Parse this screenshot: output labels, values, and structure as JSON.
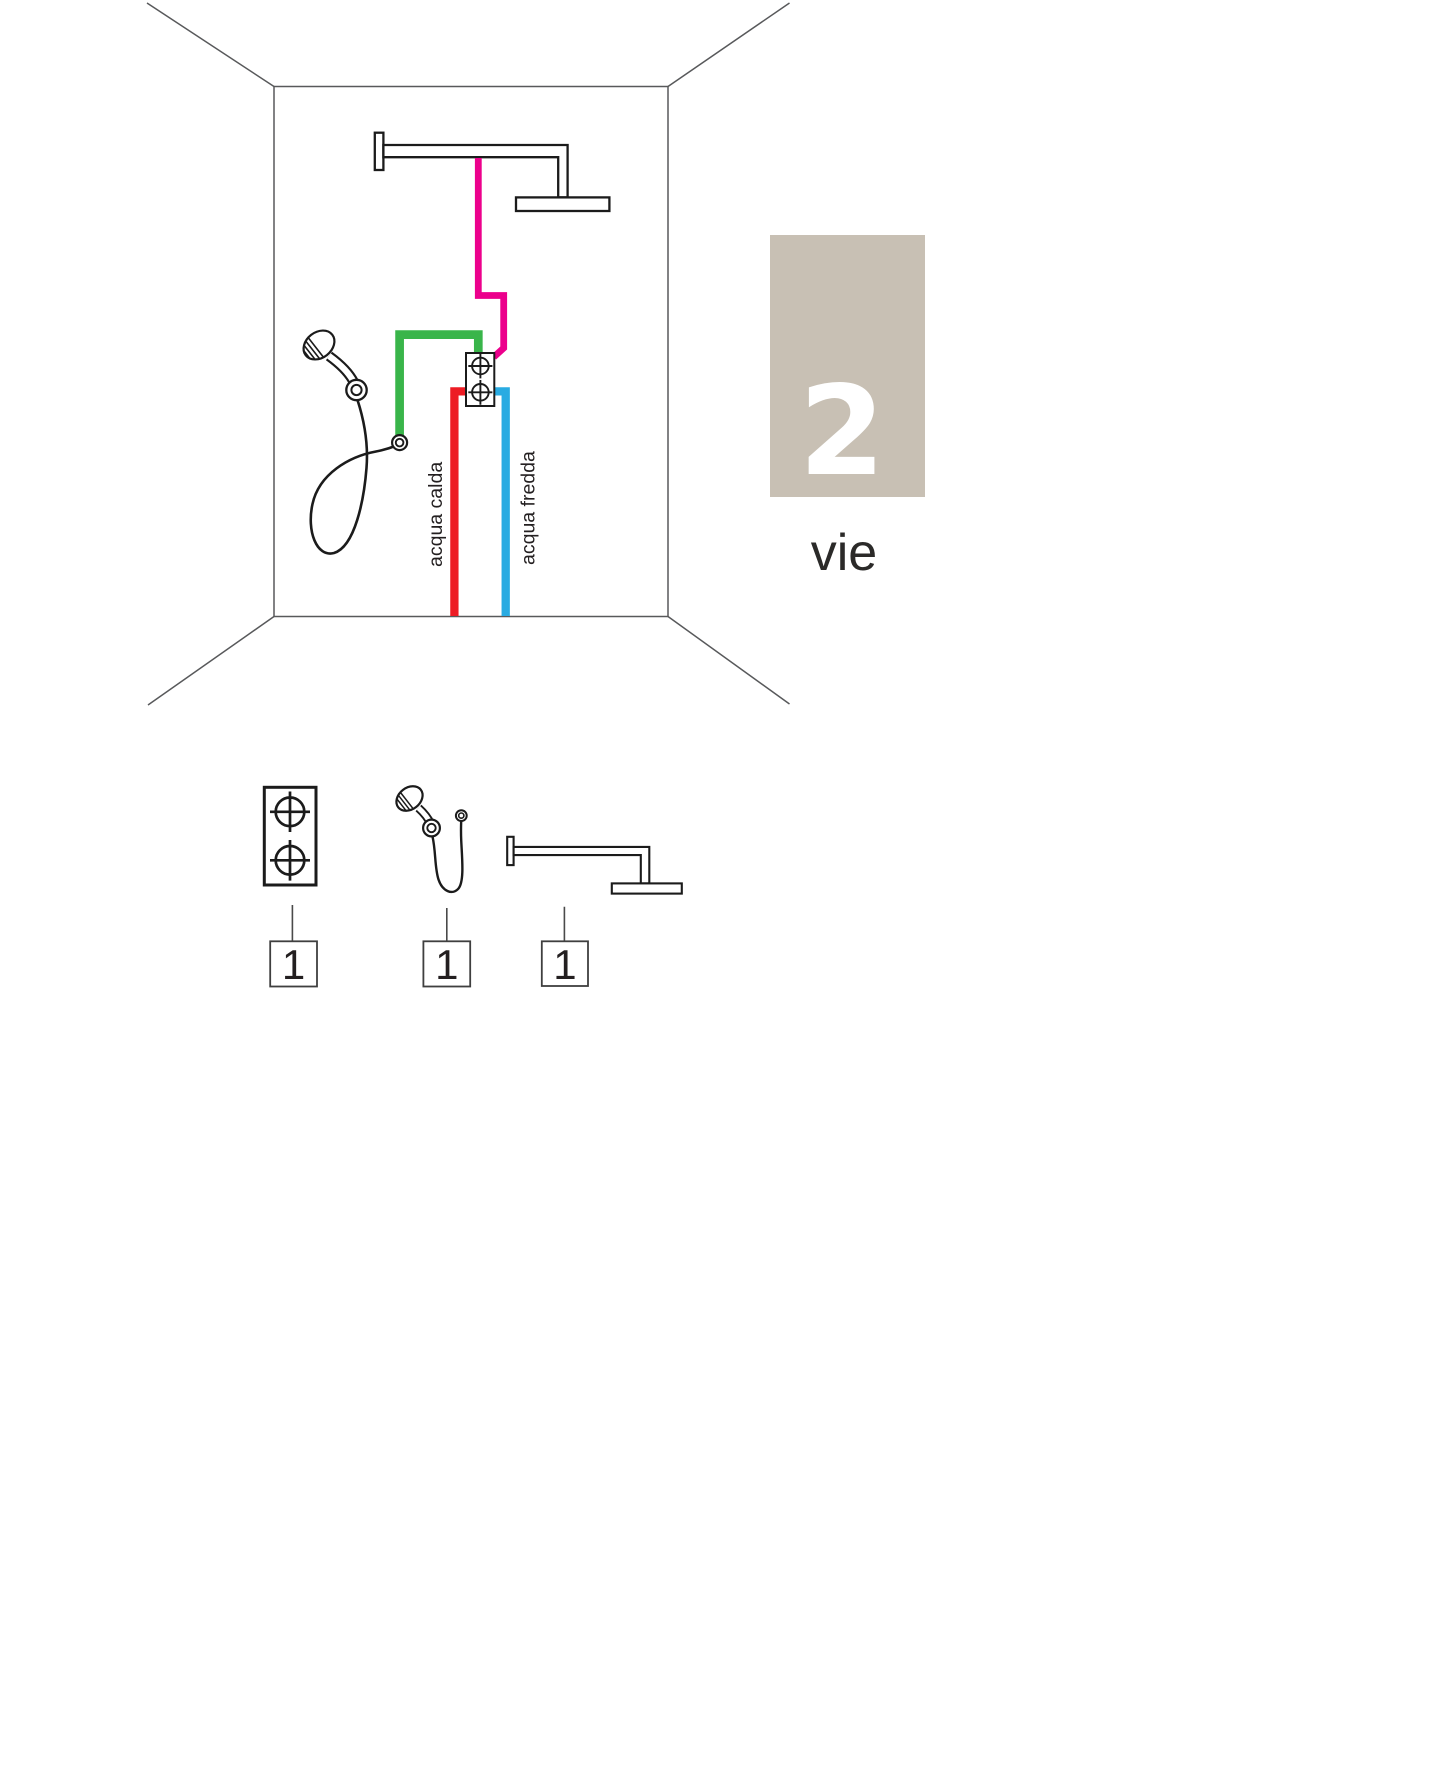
{
  "panel": {
    "number": "2",
    "label": "vie"
  },
  "labels": {
    "hot_water": "acqua calda",
    "cold_water": "acqua fredda"
  },
  "colors": {
    "hot": "#ED1C24",
    "cold": "#29ABE2",
    "head_shower_pipe": "#EC008C",
    "hand_shower_pipe": "#39B54A",
    "panel_bg": "#C8C0B4",
    "panel_number": "#FFFFFF"
  },
  "bom": [
    {
      "item": "built-in thermostatic mixer, 2 outlets",
      "qty": "1"
    },
    {
      "item": "hand shower with hose",
      "qty": "1"
    },
    {
      "item": "shower arm with head",
      "qty": "1"
    }
  ]
}
